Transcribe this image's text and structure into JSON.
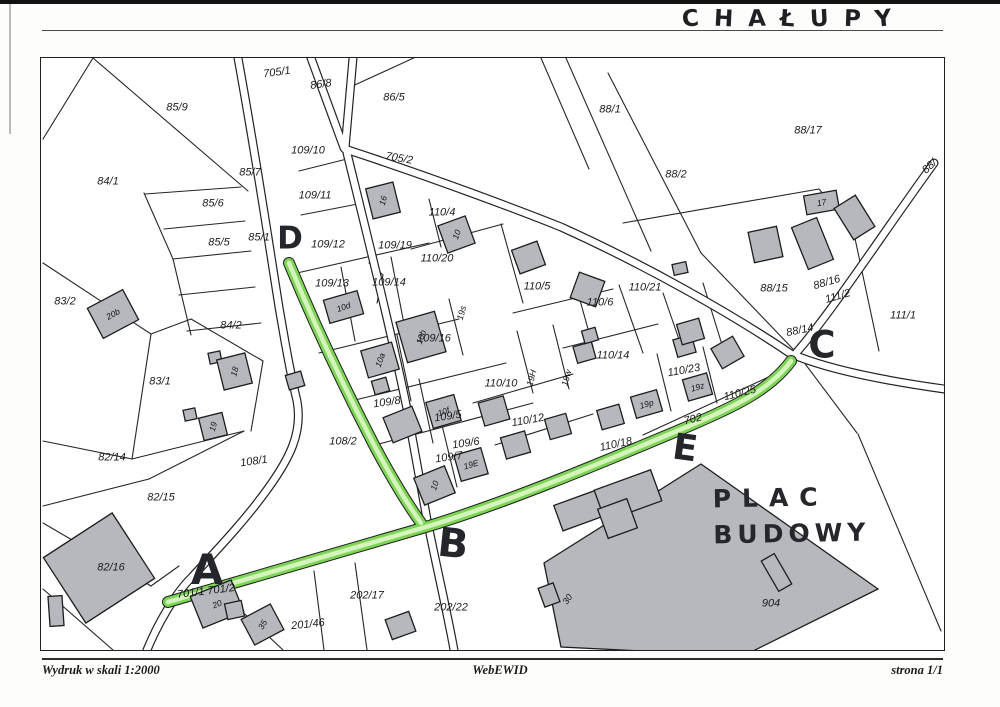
{
  "page": {
    "title_handwritten": "CHAŁUPY"
  },
  "footer": {
    "left": "Wydruk w skali 1:2000",
    "center": "WebEWID",
    "right": "strona 1/1"
  },
  "map": {
    "colors": {
      "road_green": "#7dd456",
      "road_green_light": "#d4f4bc",
      "line": "#262626",
      "building_fill": "#b5b9be",
      "building_stroke": "#1d1d1d"
    },
    "parcel_labels": [
      {
        "t": "705/1",
        "x": 276,
        "y": 72,
        "r": -8
      },
      {
        "t": "86/8",
        "x": 320,
        "y": 84,
        "r": -8
      },
      {
        "t": "86/5",
        "x": 393,
        "y": 97
      },
      {
        "t": "88/1",
        "x": 609,
        "y": 109
      },
      {
        "t": "88/17",
        "x": 807,
        "y": 130
      },
      {
        "t": "109/10",
        "x": 307,
        "y": 150
      },
      {
        "t": "705/2",
        "x": 398,
        "y": 158,
        "r": 10
      },
      {
        "t": "88/2",
        "x": 675,
        "y": 174
      },
      {
        "t": "85/9",
        "x": 176,
        "y": 107
      },
      {
        "t": "84/1",
        "x": 107,
        "y": 181
      },
      {
        "t": "85/7",
        "x": 249,
        "y": 172
      },
      {
        "t": "109/11",
        "x": 314,
        "y": 195
      },
      {
        "t": "85/6",
        "x": 212,
        "y": 203
      },
      {
        "t": "110/4",
        "x": 441,
        "y": 212
      },
      {
        "t": "85/5",
        "x": 218,
        "y": 242
      },
      {
        "t": "85/1",
        "x": 258,
        "y": 237
      },
      {
        "t": "109/12",
        "x": 327,
        "y": 244
      },
      {
        "t": "109/19",
        "x": 394,
        "y": 245
      },
      {
        "t": "110/20",
        "x": 436,
        "y": 258
      },
      {
        "t": "83/2",
        "x": 64,
        "y": 301
      },
      {
        "t": "109/13",
        "x": 331,
        "y": 283
      },
      {
        "t": "109/14",
        "x": 388,
        "y": 282
      },
      {
        "t": "110/5",
        "x": 536,
        "y": 286
      },
      {
        "t": "110/6",
        "x": 599,
        "y": 302
      },
      {
        "t": "110/21",
        "x": 644,
        "y": 287
      },
      {
        "t": "88/15",
        "x": 773,
        "y": 288
      },
      {
        "t": "88/16",
        "x": 826,
        "y": 282,
        "r": -16
      },
      {
        "t": "111/2",
        "x": 837,
        "y": 296,
        "r": -16
      },
      {
        "t": "84/2",
        "x": 230,
        "y": 325
      },
      {
        "t": "109/16",
        "x": 433,
        "y": 338
      },
      {
        "t": "88/14",
        "x": 799,
        "y": 330,
        "r": -12
      },
      {
        "t": "111/1",
        "x": 902,
        "y": 315
      },
      {
        "t": "83/1",
        "x": 159,
        "y": 381
      },
      {
        "t": "110/14",
        "x": 612,
        "y": 355
      },
      {
        "t": "110/23",
        "x": 683,
        "y": 370,
        "r": -10
      },
      {
        "t": "110/10",
        "x": 500,
        "y": 383
      },
      {
        "t": "109/8",
        "x": 386,
        "y": 402,
        "r": -8
      },
      {
        "t": "109/5",
        "x": 447,
        "y": 416,
        "r": -8
      },
      {
        "t": "110/12",
        "x": 527,
        "y": 420,
        "r": -10
      },
      {
        "t": "110/25",
        "x": 739,
        "y": 393,
        "r": -14
      },
      {
        "t": "702",
        "x": 692,
        "y": 419,
        "r": -14
      },
      {
        "t": "110/18",
        "x": 615,
        "y": 444,
        "r": -12
      },
      {
        "t": "108/2",
        "x": 342,
        "y": 441
      },
      {
        "t": "109/6",
        "x": 465,
        "y": 443,
        "r": -8
      },
      {
        "t": "109/7",
        "x": 448,
        "y": 457,
        "r": -8
      },
      {
        "t": "108/1",
        "x": 253,
        "y": 461,
        "r": -8
      },
      {
        "t": "82/14",
        "x": 111,
        "y": 457
      },
      {
        "t": "82/15",
        "x": 160,
        "y": 497
      },
      {
        "t": "82/16",
        "x": 110,
        "y": 567
      },
      {
        "t": "202/17",
        "x": 366,
        "y": 595
      },
      {
        "t": "202/22",
        "x": 450,
        "y": 607
      },
      {
        "t": "201/46",
        "x": 307,
        "y": 624,
        "r": -6
      },
      {
        "t": "904",
        "x": 770,
        "y": 603
      }
    ],
    "road_parcel_labels": [
      {
        "t": "701/1  701/2",
        "x": 205,
        "y": 591,
        "r": -7
      },
      {
        "t": "88/",
        "x": 929,
        "y": 166,
        "r": -42
      }
    ],
    "small_labels": [
      {
        "t": "19s",
        "x": 461,
        "y": 312,
        "r": -75
      },
      {
        "t": "19H",
        "x": 531,
        "y": 377,
        "r": -75
      },
      {
        "t": "19w",
        "x": 566,
        "y": 377,
        "r": -75
      }
    ],
    "buildings": [
      [
        92,
        296,
        40,
        34,
        -28,
        "20b",
        -28
      ],
      [
        208,
        351,
        12,
        11,
        -12,
        "",
        0
      ],
      [
        219,
        355,
        29,
        31,
        -14,
        "18",
        -75
      ],
      [
        183,
        408,
        12,
        11,
        -12,
        "",
        0
      ],
      [
        200,
        414,
        24,
        23,
        -14,
        "19",
        -75
      ],
      [
        57,
        528,
        82,
        78,
        -33,
        "",
        0
      ],
      [
        48,
        595,
        14,
        30,
        -4,
        "",
        0
      ],
      [
        194,
        586,
        44,
        34,
        -22,
        "20",
        -22
      ],
      [
        225,
        601,
        17,
        16,
        -12,
        "",
        0
      ],
      [
        245,
        609,
        33,
        29,
        -28,
        "35",
        -60
      ],
      [
        387,
        614,
        25,
        21,
        -20,
        "",
        0
      ],
      [
        368,
        184,
        28,
        31,
        -14,
        "16",
        -75
      ],
      [
        441,
        219,
        29,
        29,
        -20,
        "10",
        -70
      ],
      [
        325,
        294,
        35,
        24,
        -16,
        "10d",
        -20
      ],
      [
        400,
        315,
        40,
        42,
        -16,
        "10b",
        -70
      ],
      [
        363,
        345,
        32,
        28,
        -16,
        "10a",
        -70
      ],
      [
        286,
        372,
        16,
        15,
        -16,
        "",
        0
      ],
      [
        372,
        378,
        15,
        14,
        -16,
        "",
        0
      ],
      [
        417,
        470,
        33,
        29,
        -22,
        "10",
        -70
      ],
      [
        428,
        397,
        29,
        27,
        -16,
        "10f",
        -20
      ],
      [
        386,
        410,
        31,
        27,
        -22,
        "",
        0
      ],
      [
        456,
        450,
        28,
        27,
        -16,
        "19E",
        -16
      ],
      [
        480,
        398,
        26,
        24,
        -16,
        "",
        0
      ],
      [
        502,
        433,
        25,
        22,
        -16,
        "",
        0
      ],
      [
        546,
        415,
        22,
        21,
        -16,
        "",
        0
      ],
      [
        598,
        406,
        23,
        20,
        -16,
        "",
        0
      ],
      [
        632,
        392,
        27,
        22,
        -16,
        "19p",
        -16
      ],
      [
        684,
        375,
        25,
        22,
        -16,
        "19z",
        -16
      ],
      [
        674,
        336,
        19,
        18,
        -16,
        "",
        0
      ],
      [
        714,
        340,
        25,
        23,
        -30,
        "",
        0
      ],
      [
        678,
        320,
        23,
        21,
        -16,
        "",
        0
      ],
      [
        574,
        343,
        19,
        17,
        -16,
        "",
        0
      ],
      [
        582,
        328,
        14,
        13,
        -16,
        "",
        0
      ],
      [
        573,
        275,
        27,
        27,
        -70,
        "",
        0
      ],
      [
        514,
        244,
        27,
        25,
        -20,
        "",
        0
      ],
      [
        750,
        228,
        29,
        31,
        -12,
        "",
        0
      ],
      [
        804,
        192,
        33,
        19,
        -10,
        "17",
        -10
      ],
      [
        841,
        198,
        25,
        37,
        -32,
        "",
        0
      ],
      [
        798,
        220,
        27,
        45,
        -22,
        "",
        0
      ],
      [
        672,
        262,
        14,
        11,
        -12,
        "",
        0
      ],
      [
        556,
        496,
        45,
        27,
        -20,
        "",
        0
      ],
      [
        597,
        478,
        60,
        33,
        -20,
        "",
        0
      ],
      [
        601,
        502,
        31,
        31,
        -20,
        "",
        0
      ],
      [
        540,
        584,
        16,
        20,
        -20,
        "",
        0
      ],
      [
        768,
        554,
        15,
        35,
        -30,
        "",
        0
      ]
    ],
    "big_building_label": {
      "t": "30",
      "x": 566,
      "y": 604,
      "r": -55
    },
    "handwritten": {
      "letters": [
        {
          "t": "A",
          "x": 206,
          "y": 569,
          "s": 42,
          "r": 0
        },
        {
          "t": "B",
          "x": 452,
          "y": 543,
          "s": 40,
          "r": 6
        },
        {
          "t": "C",
          "x": 821,
          "y": 344,
          "s": 37,
          "r": 0
        },
        {
          "t": "D",
          "x": 289,
          "y": 238,
          "s": 31,
          "r": 0
        },
        {
          "t": "E",
          "x": 684,
          "y": 448,
          "s": 36,
          "r": 8
        }
      ],
      "site_label": {
        "line1": "PLAC",
        "line2": "BUDOWY",
        "x": 712,
        "y": 482
      }
    }
  }
}
